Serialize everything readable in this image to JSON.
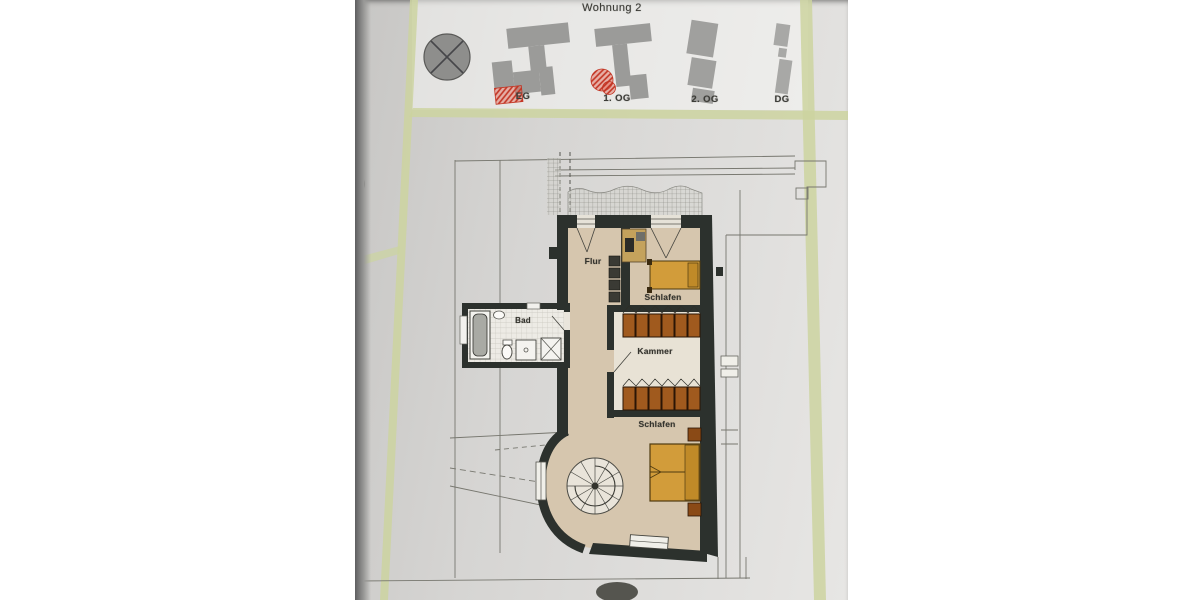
{
  "doc": {
    "title": "Wohnung 2",
    "floors": [
      {
        "label": "EG",
        "highlighted": true
      },
      {
        "label": "1. OG",
        "highlighted": true
      },
      {
        "label": "2. OG",
        "highlighted": false
      },
      {
        "label": "DG",
        "highlighted": false
      }
    ],
    "rooms": {
      "flur": "Flur",
      "bad": "Bad",
      "schlafen_upper": "Schlafen",
      "kammer": "Kammer",
      "schlafen_lower": "Schlafen"
    },
    "icons": {
      "site_marker": "tree-compass-icon",
      "keyplans": "building-footprint-icon",
      "apartment_highlight": "red-hatch-marker"
    },
    "colors": {
      "paper": "#d8d7d5",
      "frame_green": "#ccd4a0",
      "wall": "#2c312d",
      "floor_beige": "#d6c6ae",
      "floor_kammer": "#e8e2d5",
      "bath_tile": "#edebe5",
      "furniture_orange": "#d29c3a",
      "furniture_brown": "#a05a1e",
      "keyplan_gray": "#9b9b99",
      "highlight_red": "#d2452f"
    }
  }
}
